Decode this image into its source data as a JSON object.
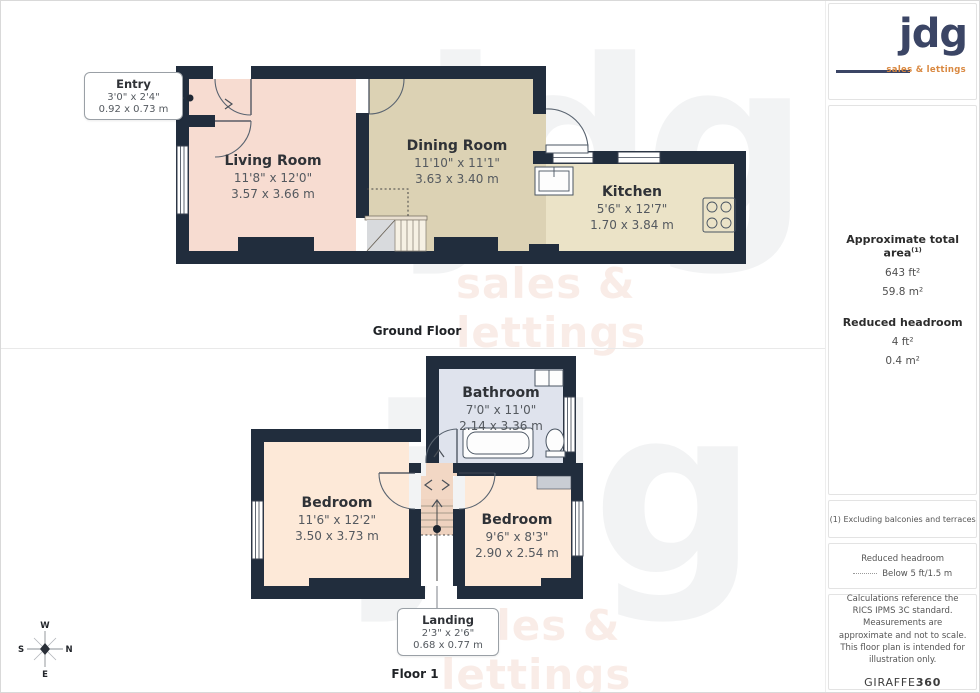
{
  "branding": {
    "logo_text": "jdg",
    "logo_tagline": "sales & lettings",
    "watermark_text": "jdg",
    "watermark_tagline": "sales & lettings"
  },
  "colors": {
    "wall": "#212d3d",
    "living_room": "#f7dcd1",
    "dining_room": "#dcd2b4",
    "kitchen": "#ebe3c7",
    "bathroom": "#dfe3ed",
    "bedroom": "#fde9d8",
    "landing": "#f2d7c4",
    "stairs_grey": "#d8dadd",
    "logo_navy": "#3b4565",
    "logo_orange": "#d98840"
  },
  "ground_floor": {
    "title": "Ground Floor",
    "rooms": {
      "entry": {
        "name": "Entry",
        "imperial": "3'0\" x 2'4\"",
        "metric": "0.92 x 0.73 m"
      },
      "living": {
        "name": "Living Room",
        "imperial": "11'8\" x 12'0\"",
        "metric": "3.57 x 3.66 m"
      },
      "dining": {
        "name": "Dining Room",
        "imperial": "11'10\" x 11'1\"",
        "metric": "3.63 x 3.40 m"
      },
      "kitchen": {
        "name": "Kitchen",
        "imperial": "5'6\" x 12'7\"",
        "metric": "1.70 x 3.84 m"
      }
    }
  },
  "floor_1": {
    "title": "Floor 1",
    "rooms": {
      "bathroom": {
        "name": "Bathroom",
        "imperial": "7'0\" x 11'0\"",
        "metric": "2.14 x 3.36 m"
      },
      "bedroom_1": {
        "name": "Bedroom",
        "imperial": "11'6\" x 12'2\"",
        "metric": "3.50 x 3.73 m"
      },
      "bedroom_2": {
        "name": "Bedroom",
        "imperial": "9'6\" x 8'3\"",
        "metric": "2.90 x 2.54 m"
      },
      "landing": {
        "name": "Landing",
        "imperial": "2'3\" x 2'6\"",
        "metric": "0.68 x 0.77 m"
      }
    }
  },
  "compass": {
    "north": "N",
    "south": "S",
    "east": "E",
    "west": "W"
  },
  "sidebar": {
    "area_title": "Approximate total area",
    "area_footnote_marker": "(1)",
    "area_ft": "643 ft²",
    "area_m": "59.8 m²",
    "headroom_title": "Reduced headroom",
    "headroom_ft": "4 ft²",
    "headroom_m": "0.4 m²",
    "footnote": "(1) Excluding balconies and terraces",
    "legend_title": "Reduced headroom",
    "legend_value": "Below 5 ft/1.5 m",
    "disclaimer": "Calculations reference the RICS IPMS 3C standard. Measurements are approximate and not to scale. This floor plan is intended for illustration only.",
    "provider": "GIRAFFE",
    "provider_suffix": "360"
  }
}
